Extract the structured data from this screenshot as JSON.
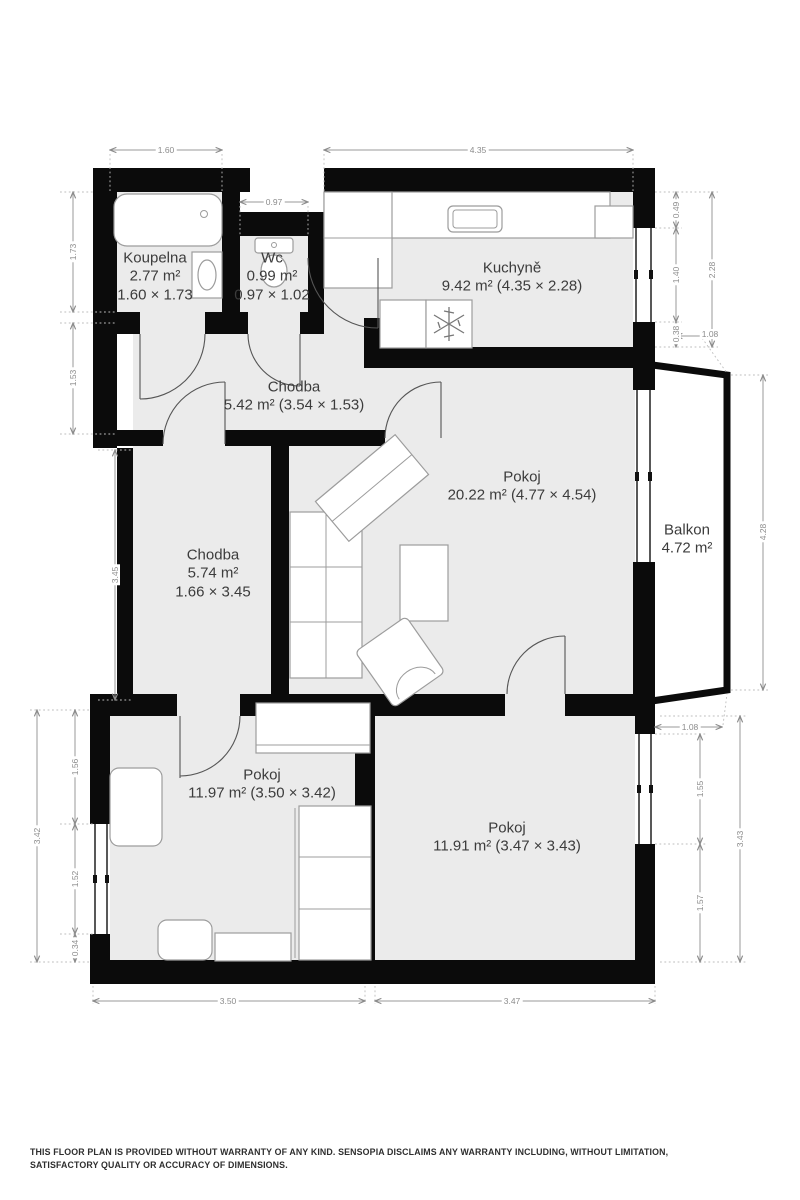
{
  "plan": {
    "rooms": [
      {
        "id": "koupelna",
        "name": "Koupelna",
        "area": "2.77 m²",
        "dims": "1.60 × 1.73"
      },
      {
        "id": "wc",
        "name": "Wc",
        "area": "0.99 m²",
        "dims": "0.97 × 1.02"
      },
      {
        "id": "kuchyne",
        "name": "Kuchyně",
        "area": "9.42 m² (4.35 × 2.28)"
      },
      {
        "id": "chodba-horni",
        "name": "Chodba",
        "area": "5.42 m² (3.54 × 1.53)"
      },
      {
        "id": "chodba-dolni",
        "name": "Chodba",
        "area": "5.74 m²",
        "dims": "1.66 × 3.45"
      },
      {
        "id": "pokoj-obyvaci",
        "name": "Pokoj",
        "area": "20.22 m² (4.77 × 4.54)"
      },
      {
        "id": "balkon",
        "name": "Balkon",
        "area": "4.72 m²"
      },
      {
        "id": "pokoj-levy-dolni",
        "name": "Pokoj",
        "area": "11.97 m² (3.50 × 3.42)"
      },
      {
        "id": "pokoj-pravy-dolni",
        "name": "Pokoj",
        "area": "11.91 m² (3.47 × 3.43)"
      }
    ],
    "dimensions": {
      "top_koupelna": "1.60",
      "top_wc": "0.97",
      "top_kuchyne": "4.35",
      "right_kuchyne_upper": "0.49",
      "right_kuchyne_window": "1.40",
      "right_kuchyne_lower": "0.38",
      "right_kuchyne_total": "2.28",
      "balkon_top_offset": "1.08",
      "balkon_length": "4.28",
      "balkon_bottom_offset": "1.08",
      "right_pokoj_window": "1.55",
      "right_pokoj_lower": "1.57",
      "right_pokoj_total": "3.43",
      "bottom_pokoj_levy": "3.50",
      "bottom_pokoj_pravy": "3.47",
      "left_koupelna": "1.73",
      "left_chodba_horni": "1.53",
      "left_chodba_dolni": "3.45",
      "left_pokoj_total": "3.42",
      "left_pokoj_upper": "1.56",
      "left_pokoj_window": "1.52",
      "left_pokoj_lower": "0.34"
    }
  },
  "footer": {
    "disclaimer": "THIS FLOOR PLAN IS PROVIDED WITHOUT WARRANTY OF ANY KIND. SENSOPIA DISCLAIMS ANY WARRANTY INCLUDING, WITHOUT LIMITATION, SATISFACTORY QUALITY OR ACCURACY OF DIMENSIONS."
  }
}
